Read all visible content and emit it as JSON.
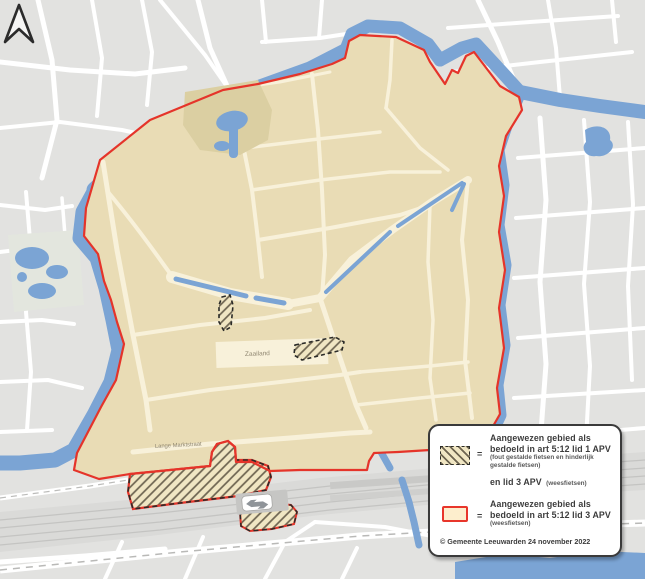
{
  "legend": {
    "equals": "=",
    "items": [
      {
        "line1": "Aangewezen gebied als",
        "line2": "bedoeld in art 5:12 lid 1 APV",
        "note1": "(fout gestalde fietsen en hinderlijk",
        "note2": "gestalde fietsen)",
        "line3_bold": "en lid 3 APV",
        "line3_note": "(weesfietsen)"
      },
      {
        "line1": "Aangewezen gebied als",
        "line2": "bedoeld in art 5:12 lid 3 APV",
        "note1": "(weesfietsen)"
      }
    ],
    "copyright": "© Gemeente Leeuwarden 24 november 2022"
  },
  "map_labels": {
    "square": "Zaailand",
    "street": "Lange Marktstraat"
  },
  "colors": {
    "boundary_red": "#e5342a",
    "water_blue": "#7ba4d4",
    "zone_block_beige": "#e9dcb5",
    "zone_street_cream": "#f8f1da",
    "outside_block_gray": "#e2e2e0",
    "hatch_stripe": "#6d6450",
    "legend_swatch_fill": "#fdeecd",
    "railway_gray": "#dadad8"
  }
}
